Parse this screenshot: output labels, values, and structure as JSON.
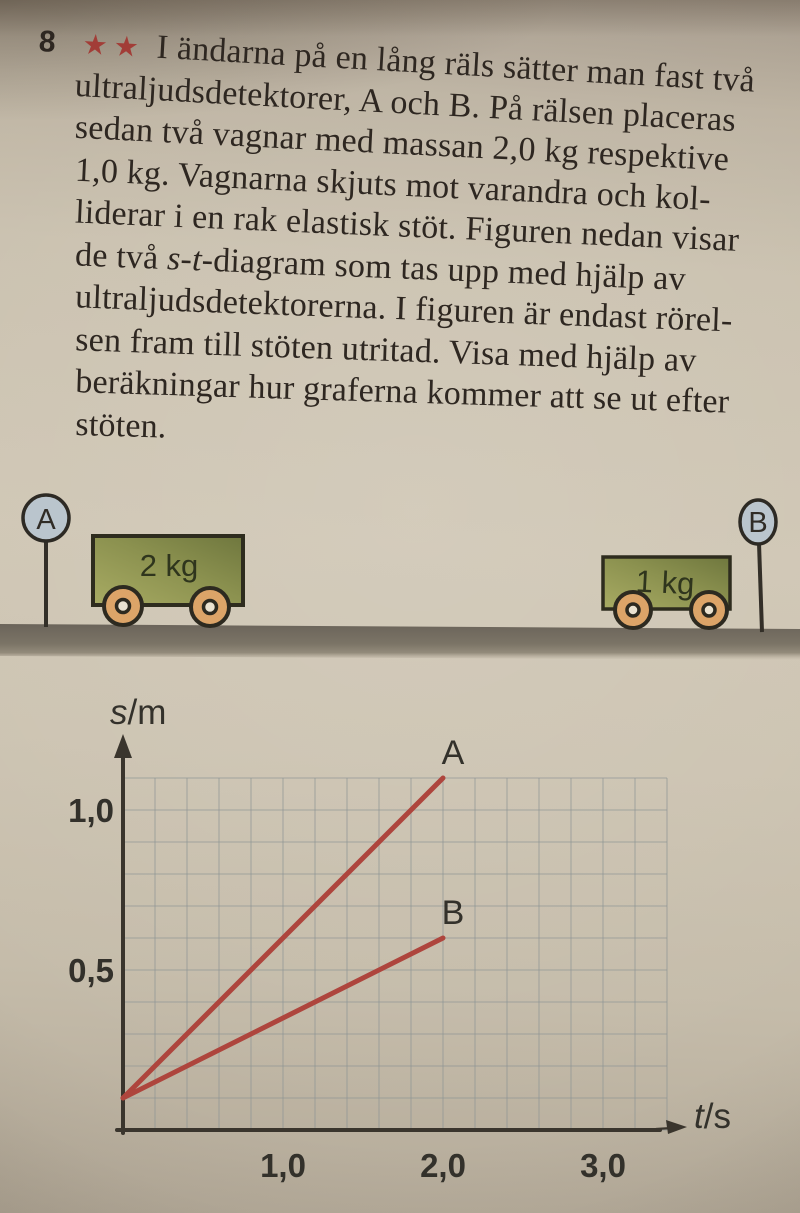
{
  "problem": {
    "number": "8",
    "stars": "★★",
    "lines": [
      "I ändarna på en lång räls sätter man fast två",
      "ultraljudsdetektorer, A och B. På rälsen placeras",
      "sedan två vagnar med massan 2,0 kg respektive",
      "1,0 kg. Vagnarna skjuts mot varandra och kol-",
      "liderar i en rak elastisk stöt. Figuren nedan visar"
    ],
    "line_st": {
      "pre": "de två ",
      "italic": "s-t",
      "post": "-diagram som tas upp med hjälp av"
    },
    "lines_tail": [
      "ultraljudsdetektorerna. I figuren är endast rörel-",
      "sen fram till stöten utritad. Visa med hjälp av",
      "beräkningar hur graferna kommer att se ut efter",
      "stöten."
    ],
    "star_color": "#a23d37"
  },
  "apparatus": {
    "detector_left": "A",
    "detector_right": "B",
    "cart_left_label": "2 kg",
    "cart_right_label": "1 kg",
    "detector_fill": "#bac5cd",
    "wheel_color": "#dca468",
    "hub_color": "#eae2d0",
    "cart_body_color": "#8b914f",
    "ground_color": "#6b645a"
  },
  "chart_data": {
    "type": "line",
    "title": "",
    "xlabel": "t/s",
    "ylabel": "s/m",
    "xlim": [
      0,
      3.4
    ],
    "ylim": [
      0,
      1.1
    ],
    "xticks": [
      {
        "value": 1.0,
        "label": "1,0"
      },
      {
        "value": 2.0,
        "label": "2,0"
      },
      {
        "value": 3.0,
        "label": "3,0"
      }
    ],
    "yticks": [
      {
        "value": 0.5,
        "label": "0,5"
      },
      {
        "value": 1.0,
        "label": "1,0"
      }
    ],
    "grid": {
      "on": true,
      "x_step_s": 0.2,
      "y_step_m": 0.1
    },
    "legend_position": "end-of-line-labels",
    "series": [
      {
        "name": "A",
        "points": [
          [
            0,
            0.1
          ],
          [
            2.0,
            1.1
          ]
        ]
      },
      {
        "name": "B",
        "points": [
          [
            0,
            0.1
          ],
          [
            2.0,
            0.6
          ]
        ]
      }
    ],
    "series_color": "#ae453d"
  }
}
